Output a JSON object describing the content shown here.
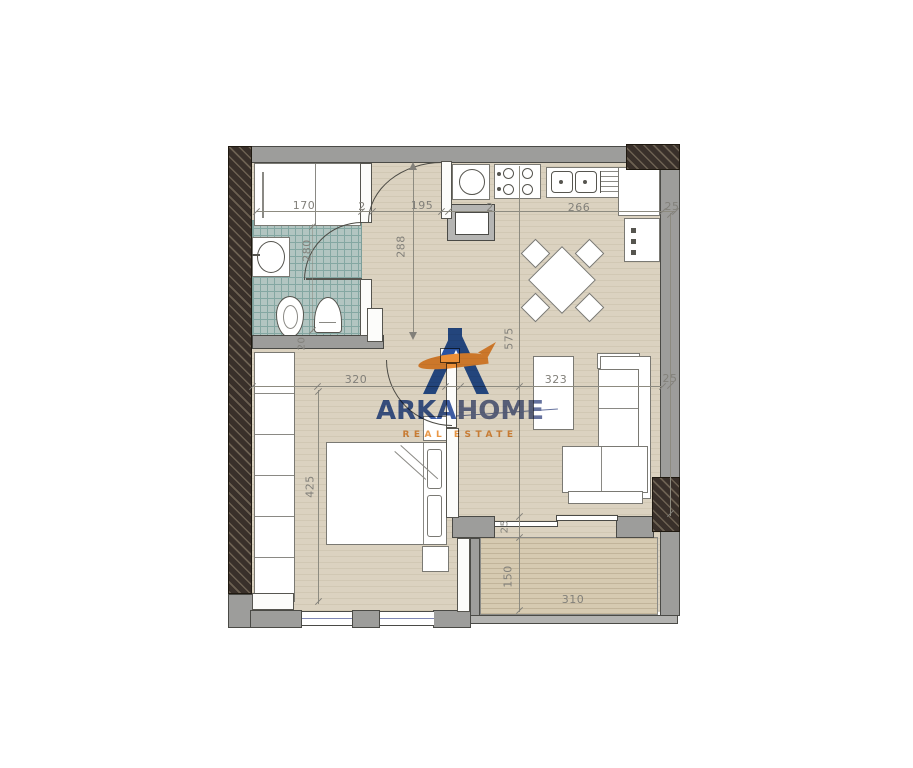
{
  "title": "Apartment floor plan drawing",
  "logo": {
    "brand_primary": "ARKA",
    "brand_secondary": "HOME",
    "tagline": "REAL ESTATE",
    "blue_primary": "#2b4f9e",
    "blue_muted": "#5d6a99",
    "orange": "#ee8b2d"
  },
  "palette": {
    "floor": "#dbd2c0",
    "wall_gray": "#9d9d9b",
    "wall_structural_dark": "#39302a",
    "bathroom_tile": "#b2c5c1",
    "balcony_floor": "#d6cab1",
    "dimension_text": "#82807a",
    "window_glass_line": "#7f86b4"
  },
  "dims": {
    "bath_width": "170",
    "wall_tick_a": "2",
    "hall_width": "195",
    "wall_tick_b": "2",
    "kitchen_width": "266",
    "right_wall_top": "25",
    "bath_depth": "280",
    "hall_depth": "288",
    "main_depth": "575",
    "bath_wall": "20",
    "bedroom_width": "320",
    "living_width": "323",
    "right_wall_mid": "25",
    "bedroom_depth": "425",
    "balcony_door_offset": "25",
    "balcony_depth": "150",
    "balcony_width": "310"
  }
}
